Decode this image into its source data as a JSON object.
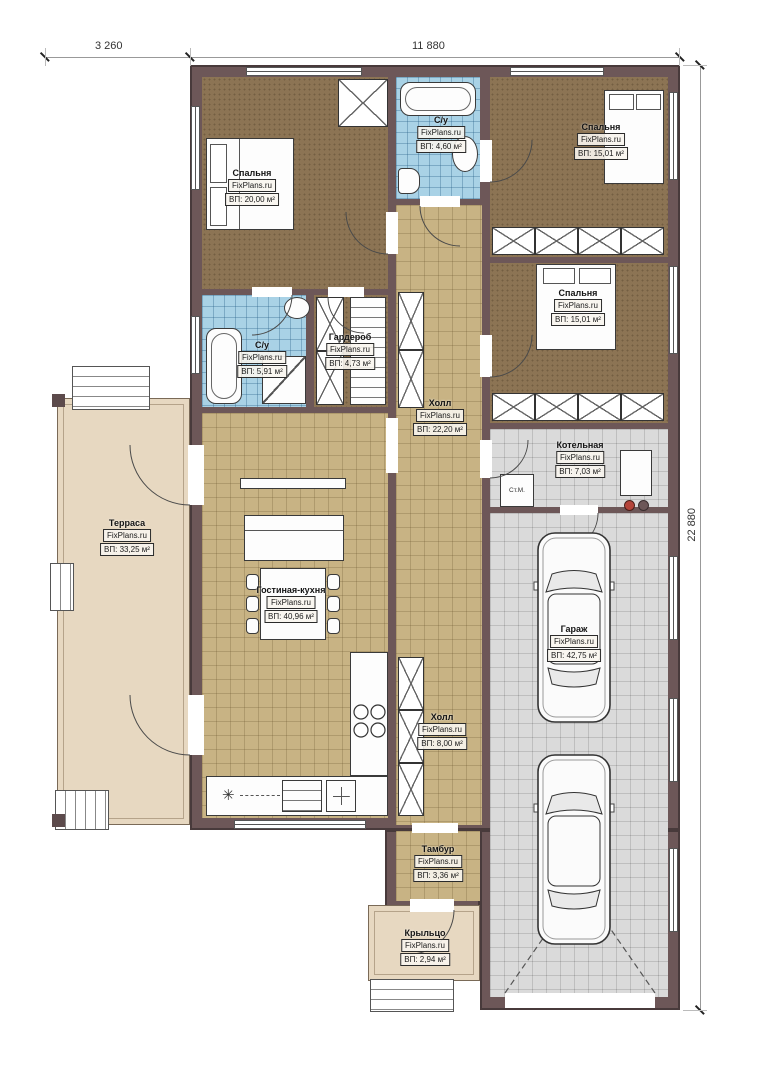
{
  "plan_title": "floor-plan",
  "watermark": "FixPlans.ru",
  "dimensions": {
    "top_left": "3 260",
    "top_main": "11 880",
    "right": "22 880"
  },
  "rooms": [
    {
      "id": "bedroom-1",
      "name": "Спальня",
      "area": "ВП: 20,00 м²"
    },
    {
      "id": "bath-1",
      "name": "С/у",
      "area": "ВП: 4,60 м²"
    },
    {
      "id": "bedroom-2",
      "name": "Спальня",
      "area": "ВП: 15,01 м²"
    },
    {
      "id": "bedroom-3",
      "name": "Спальня",
      "area": "ВП: 15,01 м²"
    },
    {
      "id": "bath-2",
      "name": "С/у",
      "area": "ВП: 5,91 м²"
    },
    {
      "id": "wardrobe",
      "name": "Гардероб",
      "area": "ВП: 4,73 м²"
    },
    {
      "id": "hall-1",
      "name": "Холл",
      "area": "ВП: 22,20 м²"
    },
    {
      "id": "boiler-room",
      "name": "Котельная",
      "area": "ВП: 7,03 м²"
    },
    {
      "id": "terrace",
      "name": "Терраса",
      "area": "ВП: 33,25 м²"
    },
    {
      "id": "living-kitchen",
      "name": "Гостиная-кухня",
      "area": "ВП: 40,96 м²"
    },
    {
      "id": "garage",
      "name": "Гараж",
      "area": "ВП: 42,75 м²"
    },
    {
      "id": "hall-2",
      "name": "Холл",
      "area": "ВП: 8,00 м²"
    },
    {
      "id": "vestibule",
      "name": "Тамбур",
      "area": "ВП: 3,36 м²"
    },
    {
      "id": "porch",
      "name": "Крыльцо",
      "area": "ВП: 2,94 м²"
    }
  ],
  "annotations": {
    "washing_machine": "Ст.М.",
    "cooktop_symbol": "✳"
  },
  "colors": {
    "wall": "#6d5758",
    "carpet": "#8c7454",
    "tile_tan": "#c8b384",
    "tile_blue": "#a9d2e6",
    "tile_gray": "#dadada",
    "terrace": "#e7d8c1"
  }
}
